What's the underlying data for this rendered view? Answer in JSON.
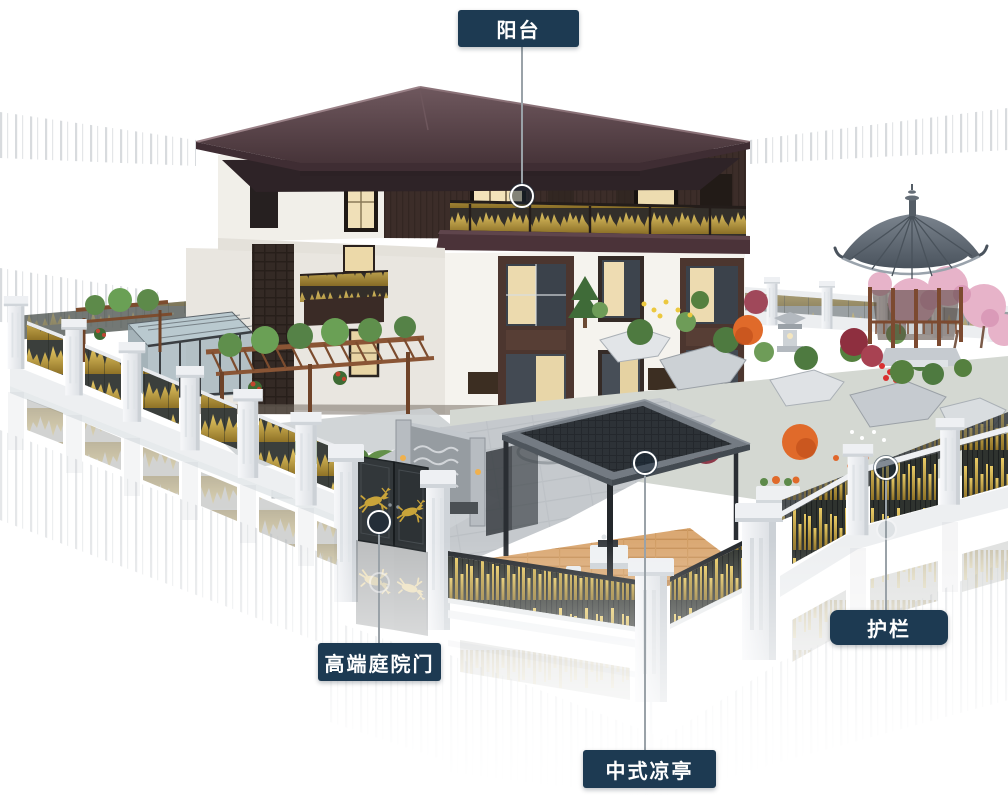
{
  "scene": {
    "alt": "3D rendering of a Chinese-style villa with walled courtyard garden, gazebo, modern pavilion, ornamental fence and gate"
  },
  "callouts": [
    {
      "id": "balcony",
      "label": "阳台"
    },
    {
      "id": "gate",
      "label": "高端庭院门"
    },
    {
      "id": "pavilion",
      "label": "中式凉亭"
    },
    {
      "id": "railing",
      "label": "护栏"
    }
  ],
  "markers": {
    "style": "ring-hotspot"
  },
  "colors": {
    "callout_bg": "#1d3a52",
    "callout_text": "#ffffff",
    "callout_line": "#9aa2a8",
    "gold_accent": "#c9a43a",
    "roof_maroon": "#4e3a40",
    "fence_panel": "#30342f",
    "post_white": "#eef0f3",
    "foliage_green": "#5d8a4a",
    "blossom_pink": "#e7b3c9",
    "gazebo_roof_gray": "#5d6670",
    "deck_wood": "#d9a873",
    "paving_gray": "#c5c9cd"
  }
}
